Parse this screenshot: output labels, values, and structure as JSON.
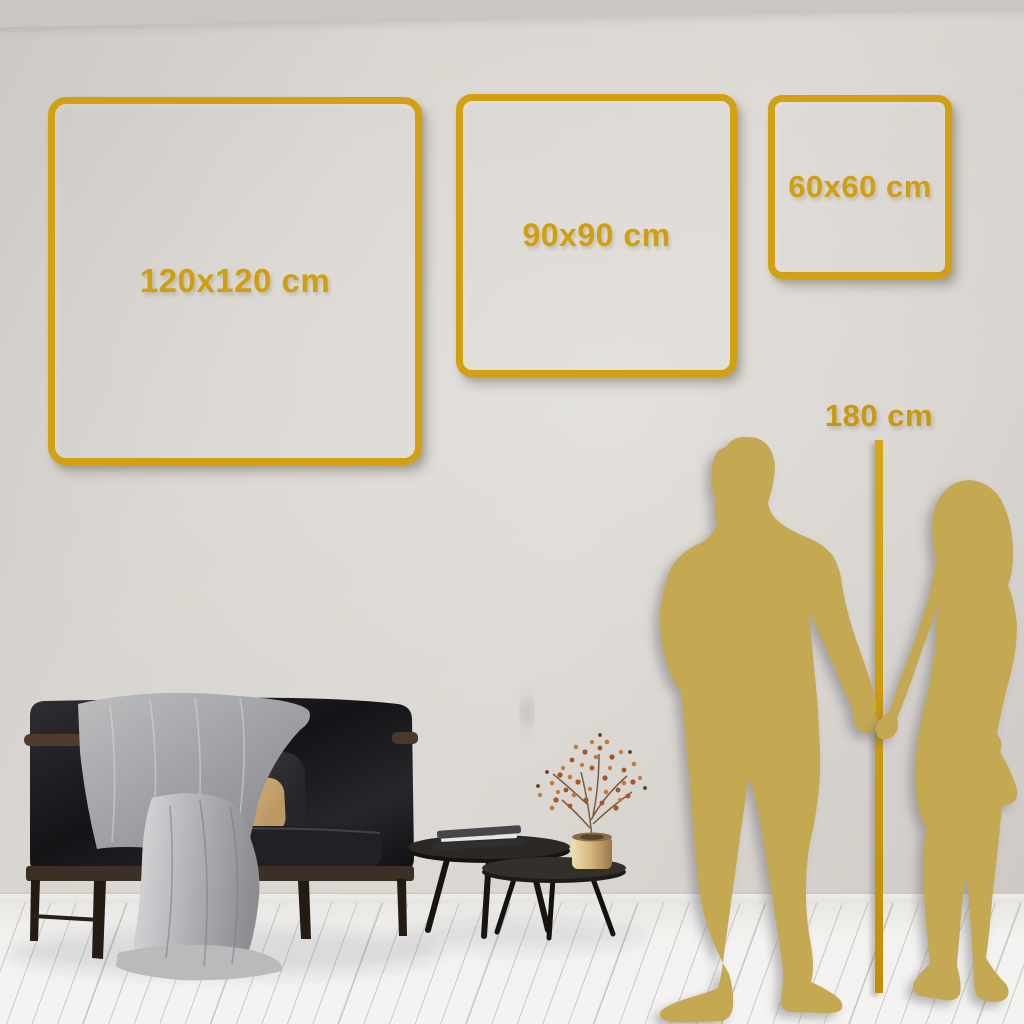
{
  "scene": {
    "description": "Wall art size guide preview in living room",
    "wall_color": "#d8d4cf",
    "floor_color": "#f2f1ef",
    "accent_gold": "#d1a013",
    "silhouette_gold": "#c5a952"
  },
  "size_frames": [
    {
      "label": "120x120 cm",
      "width_cm": 120,
      "height_cm": 120
    },
    {
      "label": "90x90 cm",
      "width_cm": 90,
      "height_cm": 90
    },
    {
      "label": "60x60 cm",
      "width_cm": 60,
      "height_cm": 60
    }
  ],
  "height_ruler": {
    "label": "180 cm",
    "height_cm": 180
  },
  "silhouettes": {
    "left": "man",
    "right": "woman"
  }
}
